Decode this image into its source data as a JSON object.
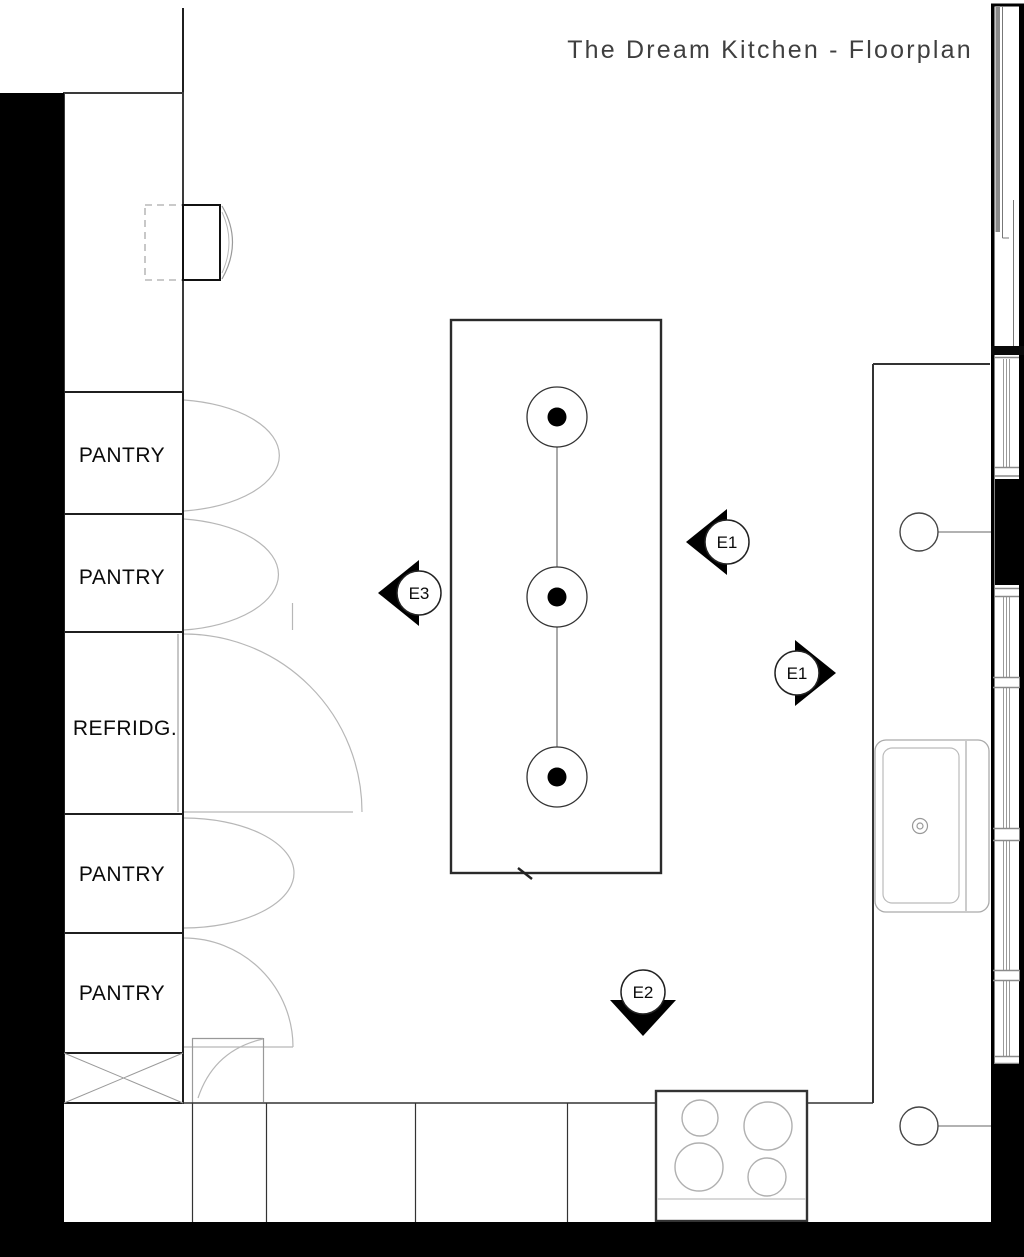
{
  "title": "The Dream Kitchen - Floorplan",
  "cabinets": {
    "items": [
      {
        "label": "PANTRY"
      },
      {
        "label": "PANTRY"
      },
      {
        "label": "REFRIDG."
      },
      {
        "label": "PANTRY"
      },
      {
        "label": "PANTRY"
      }
    ]
  },
  "markers": {
    "e1_upper": {
      "label": "E1",
      "direction": "left"
    },
    "e3": {
      "label": "E3",
      "direction": "left"
    },
    "e1_lower": {
      "label": "E1",
      "direction": "right"
    },
    "e2": {
      "label": "E2",
      "direction": "down"
    }
  },
  "fixtures": {
    "island_light_count": "3",
    "stove_burner_count": "4",
    "icons": [
      "ceiling-light-icon",
      "pendant-light-icon",
      "sink-icon",
      "stove-burner-icon",
      "door-swing-icon",
      "window-icon",
      "wall-oven-icon"
    ]
  },
  "colors": {
    "wall": "#000000",
    "drawing_line": "#333333",
    "light_line": "#aaaaaa",
    "background": "#ffffff"
  }
}
